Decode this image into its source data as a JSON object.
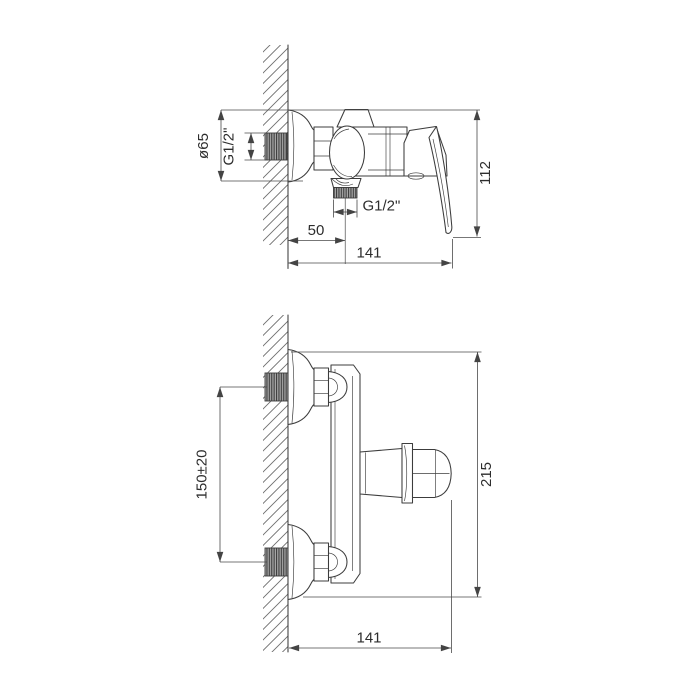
{
  "drawing": {
    "units": "mm",
    "background": "#ffffff",
    "line_color": "#3c3c3c",
    "dimension_color": "#4a4a4a",
    "text_color": "#2d2d2d",
    "side_view": {
      "dims": {
        "escutcheon_diameter": "ø65",
        "wall_inlet_thread": "G1/2\"",
        "outlet_thread": "G1/2\"",
        "wall_to_outlet_axis": "50",
        "overall_depth": "141",
        "overall_height": "112"
      }
    },
    "front_view": {
      "dims": {
        "inlet_centers_spacing": "150±20",
        "overall_height": "215",
        "overall_depth": "141"
      }
    }
  }
}
